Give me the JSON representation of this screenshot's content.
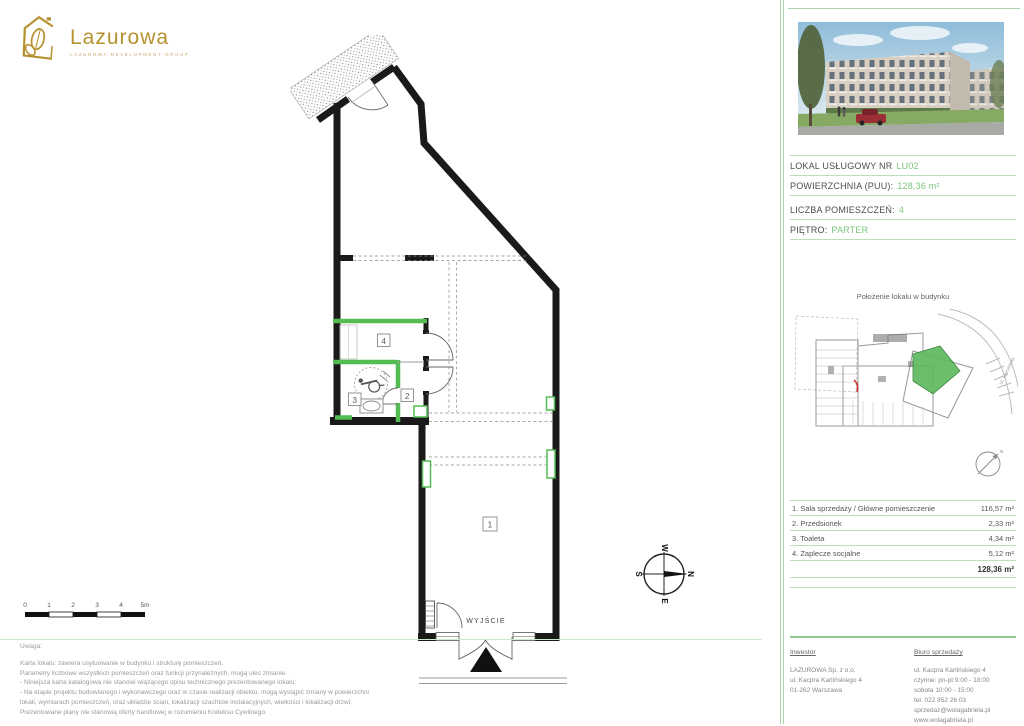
{
  "brand": {
    "name": "Lazurowa",
    "tagline": "LAZUROWA DEVELOPMENT GROUP"
  },
  "unit": {
    "rows": [
      {
        "label": "LOKAL USŁUGOWY NR",
        "value": "LU02"
      },
      {
        "label": "POWIERZCHNIA (PUU):",
        "value": "128,36 m²"
      },
      {
        "label": "LICZBA POMIESZCZEŃ:",
        "value": "4"
      },
      {
        "label": "PIĘTRO:",
        "value": "PARTER"
      }
    ]
  },
  "location_map": {
    "title": "Położenie lokalu w budynku",
    "street": "ul. Lazurowa",
    "compass_n": "N"
  },
  "plan": {
    "exit_label": "WYJŚCIE",
    "room_labels": [
      "1",
      "2",
      "3",
      "4"
    ],
    "compass": {
      "n": "N",
      "e": "E",
      "s": "S",
      "w": "W"
    }
  },
  "scalebar": {
    "ticks": [
      "0",
      "1",
      "2",
      "3",
      "4",
      "5m"
    ]
  },
  "rooms_table": {
    "items": [
      {
        "name": "1. Sala sprzedaży / Główne pomieszczenie",
        "area": "116,57 m²"
      },
      {
        "name": "2. Przedsionek",
        "area": "2,33 m²"
      },
      {
        "name": "3. Toaleta",
        "area": "4,34 m²"
      },
      {
        "name": "4. Zaplecze socjalne",
        "area": "5,12 m²"
      }
    ],
    "total": "128,36 m²"
  },
  "notes": {
    "title": "Uwaga:",
    "lines": [
      "Karta lokalu: zawiera usytuowanie w budynku i strukturę pomieszczeń.",
      "Parametry liczbowe wszystkich pomieszczeń oraz funkcji przynależnych, mogą ulec zmianie.",
      "- Niniejsza karta katalogowa nie stanowi wiążącego opisu technicznego prezentowanego lokalu;",
      "- Na etapie projektu budowlanego i wykonawczego oraz w czasie realizacji obiektu, mogą wystąpić zmiany w powierzchni",
      "lokali, wymiarach pomieszczeń, oraz układzie ścian, lokalizacji szachtów instalacyjnych, wielkości i lokalizacji drzwi;",
      "Prezentowane plany nie stanowią oferty handlowej w rozumieniu Kodeksu Cywilnego."
    ]
  },
  "footer": {
    "investor": {
      "heading": "Inwestor",
      "lines": [
        "LAZUROWA Sp. z o.o.",
        "ul. Kacpra Karlińskiego 4",
        "01-262 Warszawa"
      ]
    },
    "sales": {
      "heading": "Biuro sprzedaży",
      "lines": [
        "ul. Kacpra Karlińskiego 4",
        "czynne: pn-pt 9:00 - 18:00",
        "sobota 10:00 - 15:00",
        "tel. 022 852 26 03",
        "sprzedaz@wolagabriela.pl",
        "www.wolagabriela.pl"
      ]
    }
  },
  "colors": {
    "accent_green": "#7cc47c",
    "separator_green": "#b9e0b9",
    "wall_green": "#53bd53",
    "brand_gold": "#b5922f",
    "unit_highlight": "#5cb85c"
  }
}
